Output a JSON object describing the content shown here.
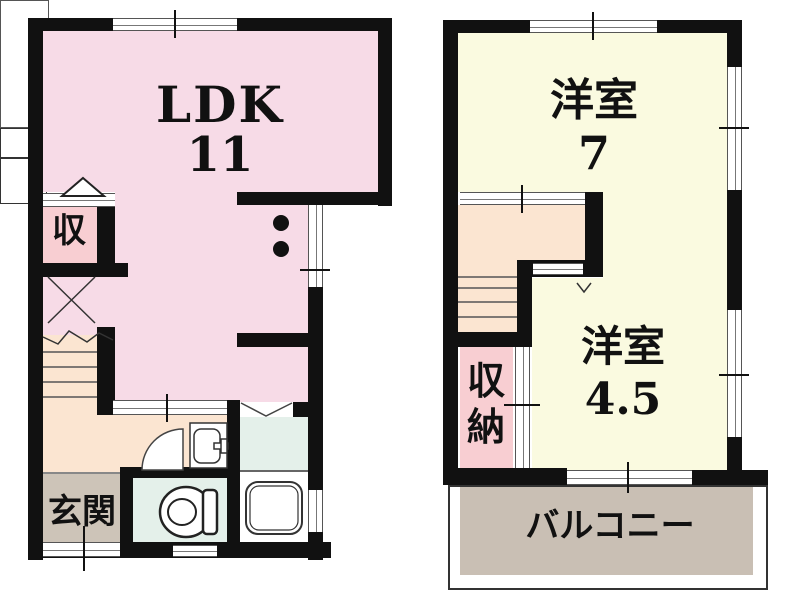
{
  "floor1": {
    "ldk_label": "LDK",
    "ldk_size": "11",
    "closet_label": "収",
    "entrance_label": "玄関"
  },
  "floor2": {
    "room7_label": "洋室",
    "room7_size": "7",
    "room45_label": "洋室",
    "room45_size": "4.5",
    "storage_char1": "収",
    "storage_char2": "納",
    "balcony_label": "バルコニー"
  },
  "colors": {
    "wall": "#111111",
    "ldk_pink": "#f7dbe7",
    "hall_peach": "#fbe5d1",
    "room_cream": "#fafae0",
    "storage_pink": "#f8ced2",
    "wet_area_mint": "#e4f0ea",
    "entrance_taupe": "#cdc4b8",
    "balcony_taupe": "#c9bfb4",
    "window_line": "#555555"
  }
}
